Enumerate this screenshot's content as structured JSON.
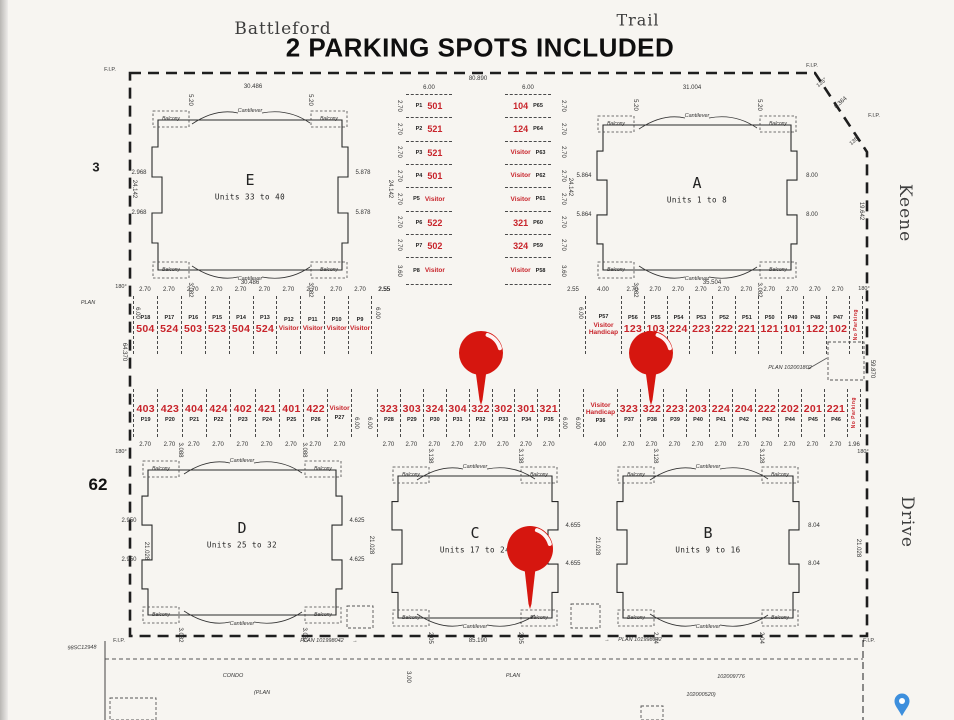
{
  "page": {
    "title": "2 PARKING SPOTS INCLUDED",
    "street_top_left": "Battleford",
    "street_top_right": "Trail",
    "street_right_upper": "Keene",
    "street_right_lower": "Drive",
    "lot_left_upper": "3",
    "lot_left_lower": "62",
    "plan_word_left": "PLAN"
  },
  "labels": {
    "fip": "F.I.P.",
    "deg180": "180°",
    "deg135": "135°",
    "cantilever": "Cantilever",
    "balcony": "Balcony",
    "no_parking": "No Parking",
    "visitor": "Visitor",
    "handicap": "Handicap"
  },
  "survey_dims": {
    "top": "80.890",
    "top_left_seg": "30.486",
    "top_right_seg": "31.004",
    "e_bottom": "30.486",
    "a_bottom": "35.504",
    "corner_cut": "8.364",
    "right_upper": "19.642",
    "right_mid": "59.870",
    "left_mid": "64.370",
    "d24142": "24.142",
    "d21028": "21.028",
    "aisle_600": "6.00",
    "gap_255": "2.55"
  },
  "buildings": [
    {
      "letter": "E",
      "units": "Units 33 to 40",
      "left": [
        "2.968",
        "2.968"
      ],
      "right": [
        "5.878",
        "5.878"
      ],
      "top_marks": [
        "5.20",
        "5.20"
      ],
      "bottom_marks": [
        "3.082",
        "3.082"
      ]
    },
    {
      "letter": "A",
      "units": "Units 1 to 8",
      "left": [
        "5.864",
        "5.864"
      ],
      "right": [
        "8.00",
        "8.00"
      ],
      "top_marks": [
        "5.20",
        "5.20"
      ],
      "bottom_marks": [
        "3.082",
        "3.082"
      ]
    },
    {
      "letter": "D",
      "units": "Units 25 to 32",
      "left": [
        "2.950",
        "2.950"
      ],
      "right": [
        "4.625",
        "4.625"
      ],
      "top_marks": [
        "3.088",
        "3.088"
      ],
      "bottom_marks": [
        "3.082",
        "3.082"
      ]
    },
    {
      "letter": "C",
      "units": "Units 17 to 24",
      "left": [],
      "right": [
        "4.655",
        "4.655"
      ],
      "top_marks": [
        "3.138",
        "3.138"
      ],
      "bottom_marks": [
        "2.05",
        "2.05"
      ]
    },
    {
      "letter": "B",
      "units": "Units 9 to 16",
      "left": [],
      "right": [
        "8.04",
        "8.04"
      ],
      "top_marks": [
        "3.128",
        "3.128"
      ],
      "bottom_marks": [
        "2.04",
        "2.04"
      ]
    }
  ],
  "parking": {
    "col_left": {
      "top_dim": "6.00",
      "stalls": [
        {
          "id": "P1",
          "spot": "501"
        },
        {
          "id": "P2",
          "spot": "521"
        },
        {
          "id": "P3",
          "spot": "521"
        },
        {
          "id": "P4",
          "spot": "501"
        },
        {
          "id": "P5",
          "spot": "Visitor"
        },
        {
          "id": "P6",
          "spot": "522"
        },
        {
          "id": "P7",
          "spot": "502"
        },
        {
          "id": "P8",
          "spot": "Visitor"
        }
      ],
      "dims": [
        "2.70",
        "2.70",
        "2.70",
        "2.70",
        "2.70",
        "2.70",
        "2.70",
        "3.60"
      ]
    },
    "col_right": {
      "top_dim": "6.00",
      "stalls": [
        {
          "id": "P65",
          "spot": "104"
        },
        {
          "id": "P64",
          "spot": "124"
        },
        {
          "id": "P63",
          "spot": "Visitor"
        },
        {
          "id": "P62",
          "spot": "Visitor"
        },
        {
          "id": "P61",
          "spot": "Visitor"
        },
        {
          "id": "P60",
          "spot": "321"
        },
        {
          "id": "P59",
          "spot": "324"
        },
        {
          "id": "P58",
          "spot": "Visitor"
        }
      ],
      "dims": [
        "2.70",
        "2.70",
        "2.70",
        "2.70",
        "2.70",
        "2.70",
        "2.70",
        "3.60"
      ]
    },
    "upper_left": {
      "stalls": [
        {
          "id": "P18",
          "spot": "504"
        },
        {
          "id": "P17",
          "spot": "524"
        },
        {
          "id": "P16",
          "spot": "503"
        },
        {
          "id": "P15",
          "spot": "523"
        },
        {
          "id": "P14",
          "spot": "504"
        },
        {
          "id": "P13",
          "spot": "524"
        },
        {
          "id": "P12",
          "spot": "Visitor"
        },
        {
          "id": "P11",
          "spot": "Visitor"
        },
        {
          "id": "P10",
          "spot": "Visitor"
        },
        {
          "id": "P9",
          "spot": "Visitor"
        }
      ],
      "dims": [
        "2.70",
        "2.70",
        "2.70",
        "2.70",
        "2.70",
        "2.70",
        "2.70",
        "2.70",
        "2.70",
        "2.70",
        "2.55"
      ]
    },
    "upper_right": {
      "lead_dim": "2.55",
      "stalls": [
        {
          "id": "P57",
          "spot": "Visitor",
          "spot2": "Handicap"
        },
        {
          "id": "P56",
          "spot": "123"
        },
        {
          "id": "P55",
          "spot": "103"
        },
        {
          "id": "P54",
          "spot": "224"
        },
        {
          "id": "P53",
          "spot": "223"
        },
        {
          "id": "P52",
          "spot": "222"
        },
        {
          "id": "P51",
          "spot": "221"
        },
        {
          "id": "P50",
          "spot": "121"
        },
        {
          "id": "P49",
          "spot": "101"
        },
        {
          "id": "P48",
          "spot": "122"
        },
        {
          "id": "P47",
          "spot": "102"
        }
      ],
      "dims": [
        "4.00",
        "2.70",
        "2.70",
        "2.70",
        "2.70",
        "2.70",
        "2.70",
        "2.70",
        "2.70",
        "2.70",
        "2.70"
      ],
      "no_parking": true
    },
    "lower_left": {
      "stalls": [
        {
          "id": "P19",
          "spot": "403"
        },
        {
          "id": "P20",
          "spot": "423"
        },
        {
          "id": "P21",
          "spot": "404"
        },
        {
          "id": "P22",
          "spot": "424"
        },
        {
          "id": "P23",
          "spot": "402"
        },
        {
          "id": "P24",
          "spot": "421"
        },
        {
          "id": "P25",
          "spot": "401"
        },
        {
          "id": "P26",
          "spot": "422"
        },
        {
          "id": "P27",
          "spot": "Visitor"
        }
      ],
      "dims": [
        "2.70",
        "2.70",
        "2.70",
        "2.70",
        "2.70",
        "2.70",
        "2.70",
        "2.70",
        "2.70"
      ]
    },
    "lower_mid": {
      "stalls": [
        {
          "id": "P28",
          "spot": "323"
        },
        {
          "id": "P29",
          "spot": "303"
        },
        {
          "id": "P30",
          "spot": "324"
        },
        {
          "id": "P31",
          "spot": "304"
        },
        {
          "id": "P32",
          "spot": "322"
        },
        {
          "id": "P33",
          "spot": "302"
        },
        {
          "id": "P34",
          "spot": "301"
        },
        {
          "id": "P35",
          "spot": "321"
        }
      ],
      "dims": [
        "2.70",
        "2.70",
        "2.70",
        "2.70",
        "2.70",
        "2.70",
        "2.70",
        "2.70"
      ]
    },
    "lower_right": {
      "stalls": [
        {
          "id": "P36",
          "spot": "Visitor",
          "spot2": "Handicap"
        },
        {
          "id": "P37",
          "spot": "323"
        },
        {
          "id": "P38",
          "spot": "322"
        },
        {
          "id": "P39",
          "spot": "223"
        },
        {
          "id": "P40",
          "spot": "203"
        },
        {
          "id": "P41",
          "spot": "224"
        },
        {
          "id": "P42",
          "spot": "204"
        },
        {
          "id": "P43",
          "spot": "222"
        },
        {
          "id": "P44",
          "spot": "202"
        },
        {
          "id": "P45",
          "spot": "201"
        },
        {
          "id": "P46",
          "spot": "221"
        }
      ],
      "dims": [
        "4.00",
        "2.70",
        "2.70",
        "2.70",
        "2.70",
        "2.70",
        "2.70",
        "2.70",
        "2.70",
        "2.70",
        "2.70",
        "1.96"
      ],
      "no_parking": true
    }
  },
  "footer": {
    "plan_number_left": "PLAN 101998042",
    "plan_number_right": "PLAN 101998042",
    "plan_area_ref": "PLAN 102001802",
    "bottom_dim": "85.190",
    "condo": "CONDO",
    "plan_paren": "(PLAN",
    "ref1": "102009776",
    "ref2": "102000520)",
    "side_ref": "98SC12948",
    "plan_word": "PLAN",
    "offset_dim": "3.00",
    "arrow": "→"
  },
  "pins": [
    {
      "type": "red-marker",
      "points_to": "322 (P32)"
    },
    {
      "type": "red-marker",
      "points_to": "322 (P38)"
    },
    {
      "type": "red-marker",
      "points_to": "Building C"
    },
    {
      "type": "blue-marker",
      "points_to": ""
    }
  ],
  "colors": {
    "red": "#c8242b",
    "pin_red": "#d6160f",
    "line": "#1e1e1e",
    "paper": "#f7f5f1",
    "pin_blue": "#3d8fdd"
  }
}
